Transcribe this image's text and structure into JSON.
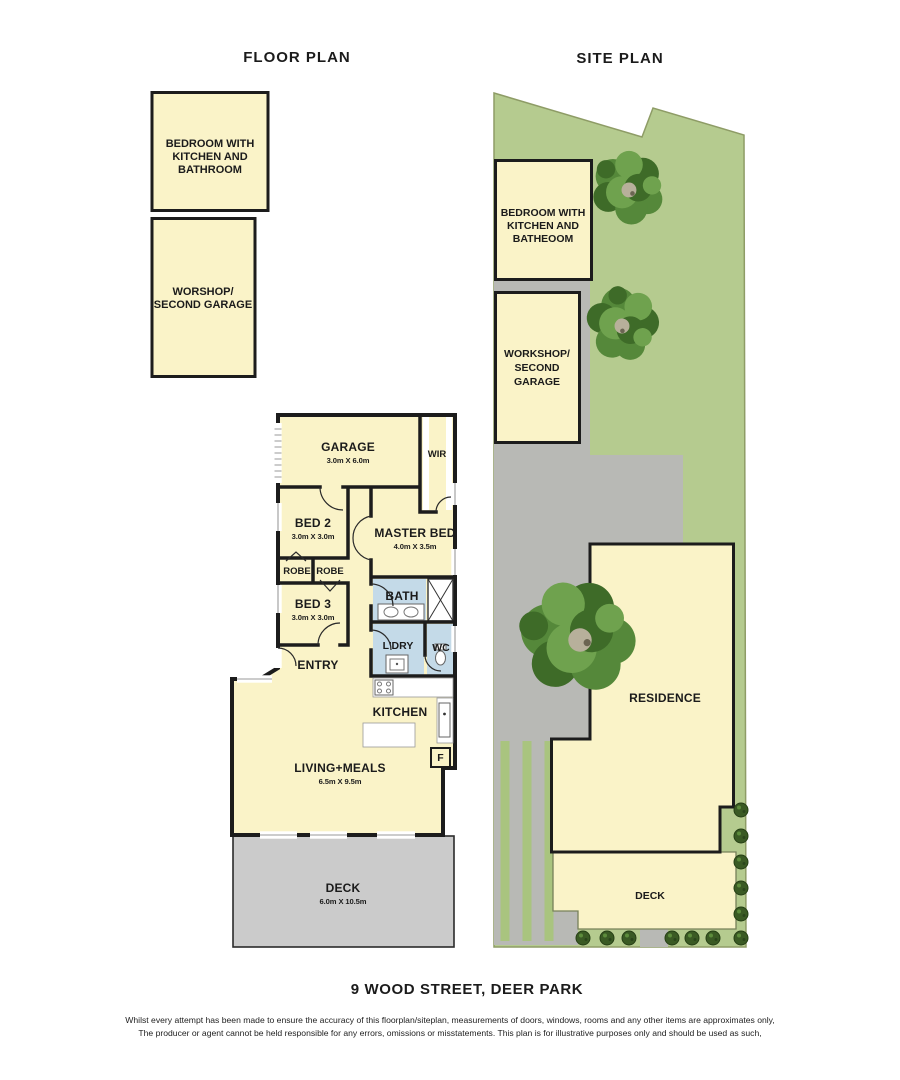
{
  "header": {
    "floor_plan_title": "FLOOR PLAN",
    "site_plan_title": "SITE PLAN"
  },
  "floor_plan": {
    "outbuilding_bedroom": {
      "line1": "BEDROOM WITH",
      "line2": "KITCHEN AND",
      "line3": "BATHROOM"
    },
    "outbuilding_workshop": {
      "line1": "WORSHOP/",
      "line2": "SECOND GARAGE"
    },
    "garage": {
      "name": "GARAGE",
      "dims": "3.0m X 6.0m"
    },
    "wir": {
      "name": "WIR"
    },
    "bed2": {
      "name": "BED 2",
      "dims": "3.0m X 3.0m"
    },
    "master": {
      "name": "MASTER BED",
      "dims": "4.0m X 3.5m"
    },
    "robe1": {
      "name": "ROBE"
    },
    "robe2": {
      "name": "ROBE"
    },
    "bed3": {
      "name": "BED 3",
      "dims": "3.0m X 3.0m"
    },
    "bath": {
      "name": "BATH"
    },
    "ldry": {
      "name": "L'DRY"
    },
    "wc": {
      "name": "WC"
    },
    "entry": {
      "name": "ENTRY"
    },
    "kitchen": {
      "name": "KITCHEN"
    },
    "living": {
      "name": "LIVING+MEALS",
      "dims": "6.5m X 9.5m"
    },
    "fridge": {
      "name": "F"
    },
    "deck": {
      "name": "DECK",
      "dims": "6.0m X 10.5m"
    }
  },
  "site_plan": {
    "bedroom_unit": {
      "line1": "BEDROOM WITH",
      "line2": "KITCHEN AND",
      "line3": "BATHEOOM"
    },
    "workshop": {
      "line1": "WORKSHOP/",
      "line2": "SECOND",
      "line3": "GARAGE"
    },
    "residence": {
      "name": "RESIDENCE"
    },
    "deck": {
      "name": "DECK"
    }
  },
  "footer": {
    "address": "9 WOOD STREET, DEER PARK",
    "disclaimer_line1": "Whilst every attempt has been made to ensure the accuracy of this floorplan/siteplan, measurements of doors, windows, rooms and any other items are approximates only,",
    "disclaimer_line2": "The producer or agent cannot be held responsible for any errors, omissions or misstatements. This plan is for illustrative purposes only and should be used as such,"
  },
  "colors": {
    "wall_black": "#1c1c1c",
    "room_yellow": "#FAF3C8",
    "wet_blue": "#C4DAE8",
    "deck_gray": "#CBCBCB",
    "drive_gray": "#B8B9B5",
    "lawn_green": "#B5CB8F",
    "stripe_green": "#A9C47F",
    "bush_green": "#3A5A24",
    "parcel_border": "#8E9C66",
    "tree_dark": "#3E6B28",
    "tree_mid": "#55883A",
    "tree_light": "#6FA24E"
  }
}
